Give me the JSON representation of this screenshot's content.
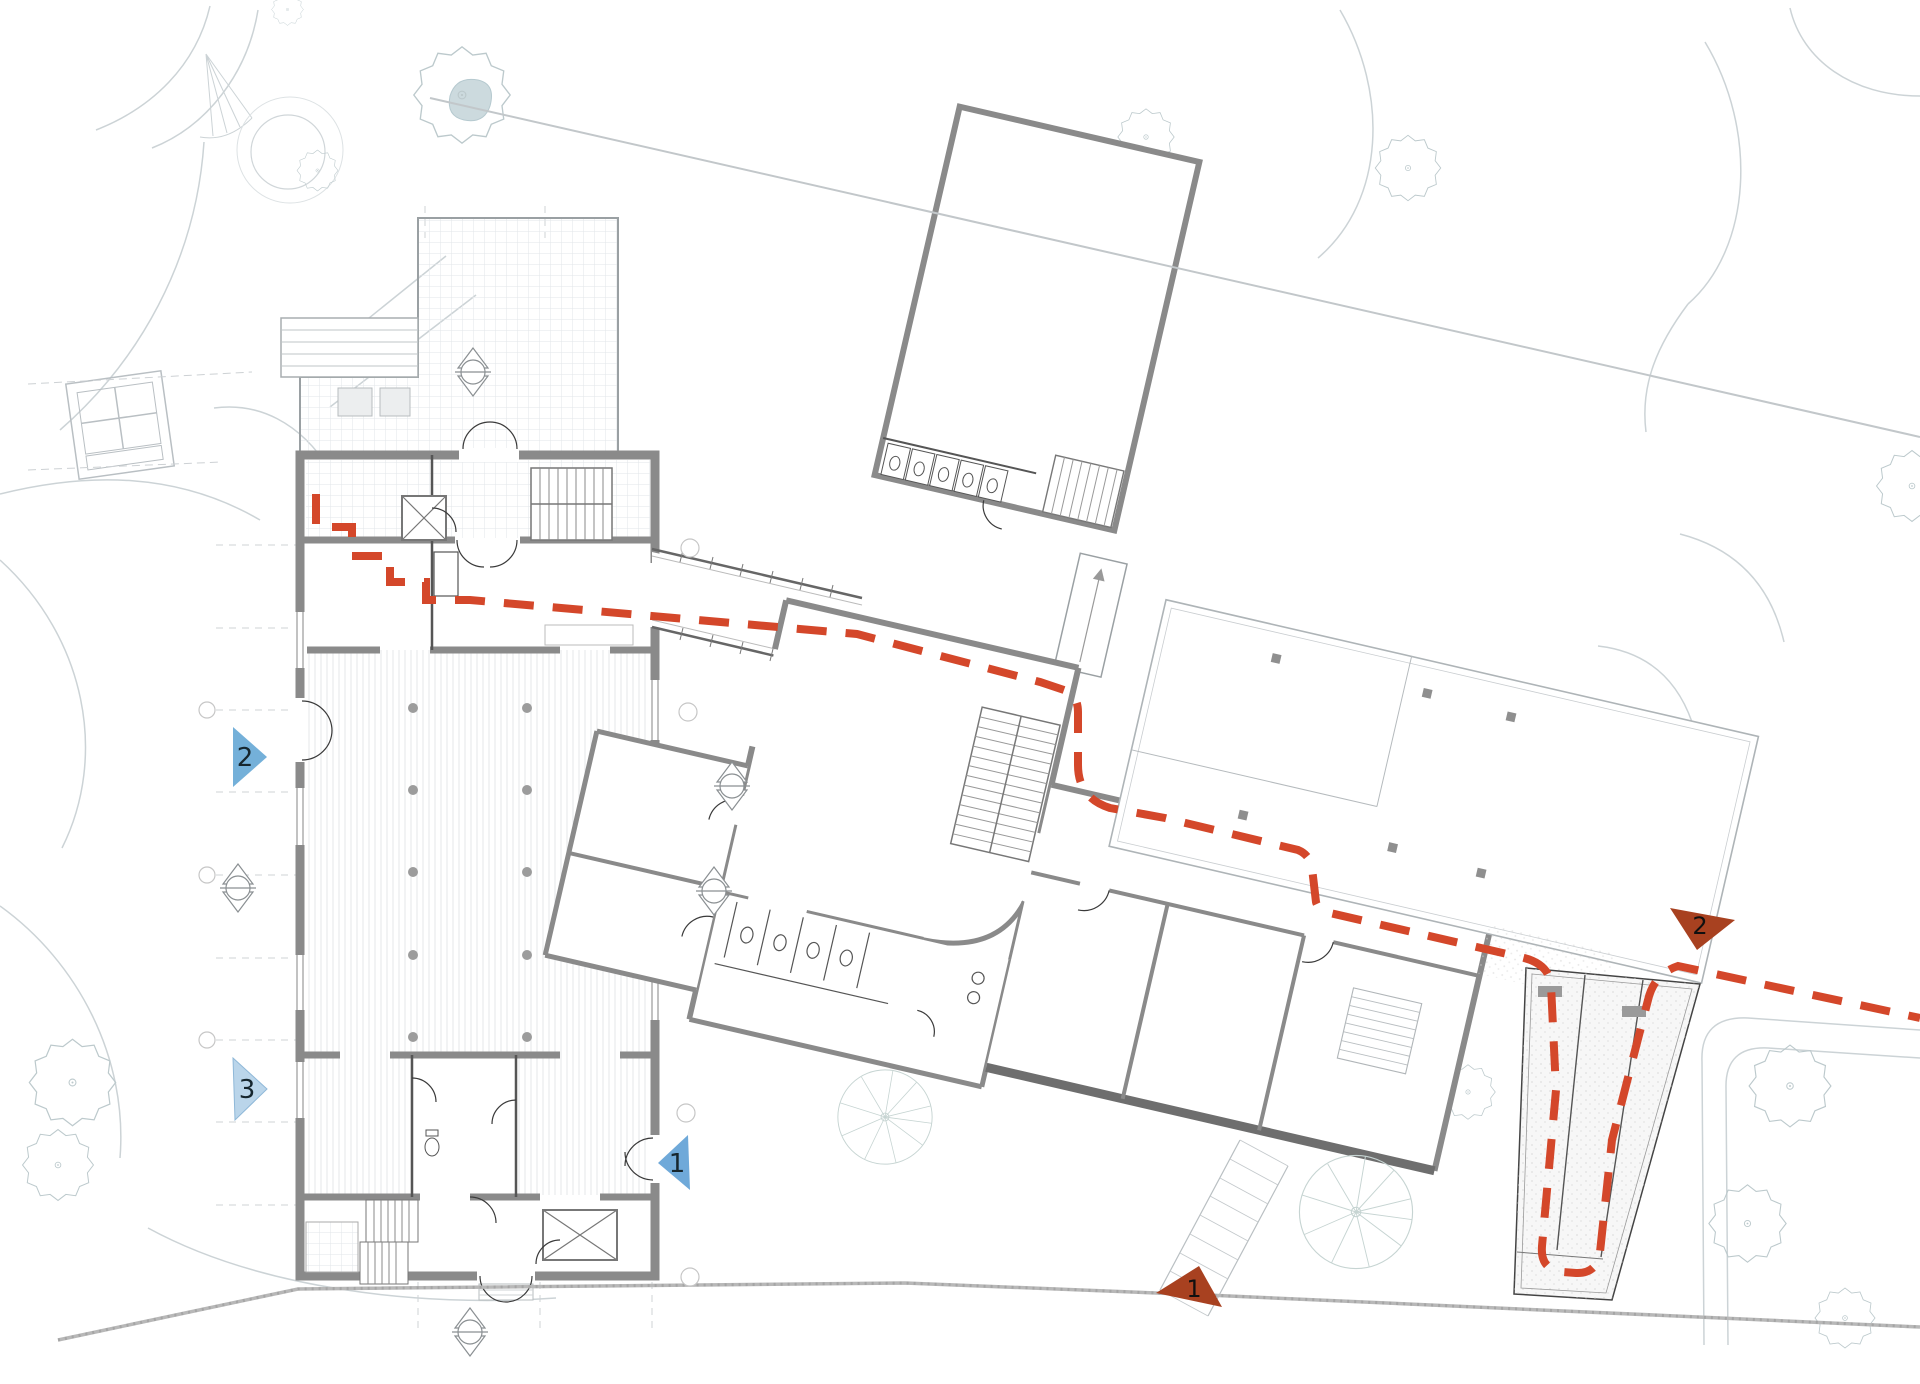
{
  "plan": {
    "kind": "architectural site plan with marked visitor route",
    "visible_text": [
      "2",
      "3",
      "1",
      "1",
      "2"
    ]
  },
  "markers": {
    "blue": [
      {
        "label": "2",
        "color": "#74B0D9",
        "points": "right",
        "location": "west facade double door"
      },
      {
        "label": "3",
        "color": "#BAD5EA",
        "points": "right",
        "location": "west facade south window bay"
      },
      {
        "label": "1",
        "color": "#6FA9D9",
        "points": "left",
        "location": "east facade door of west building"
      }
    ],
    "red": [
      {
        "label": "1",
        "color": "#A84120",
        "points": "down-left",
        "location": "south site boundary entrance"
      },
      {
        "label": "2",
        "color": "#A84120",
        "points": "down",
        "location": "east ramp entrance"
      }
    ]
  },
  "route": {
    "color": "#D4472A",
    "style": "dashed",
    "description": "red dashed path from west building through link, central block and switchback ramp to east site edge"
  },
  "palette": {
    "walls": "#8A8A8A",
    "thin_walls": "#555555",
    "site_lines": "#C9CED1",
    "vegetation": "#BCC9CC",
    "boundary": "#B8B8B8",
    "water": "#CCDADE",
    "paper": "#FFFFFF"
  }
}
